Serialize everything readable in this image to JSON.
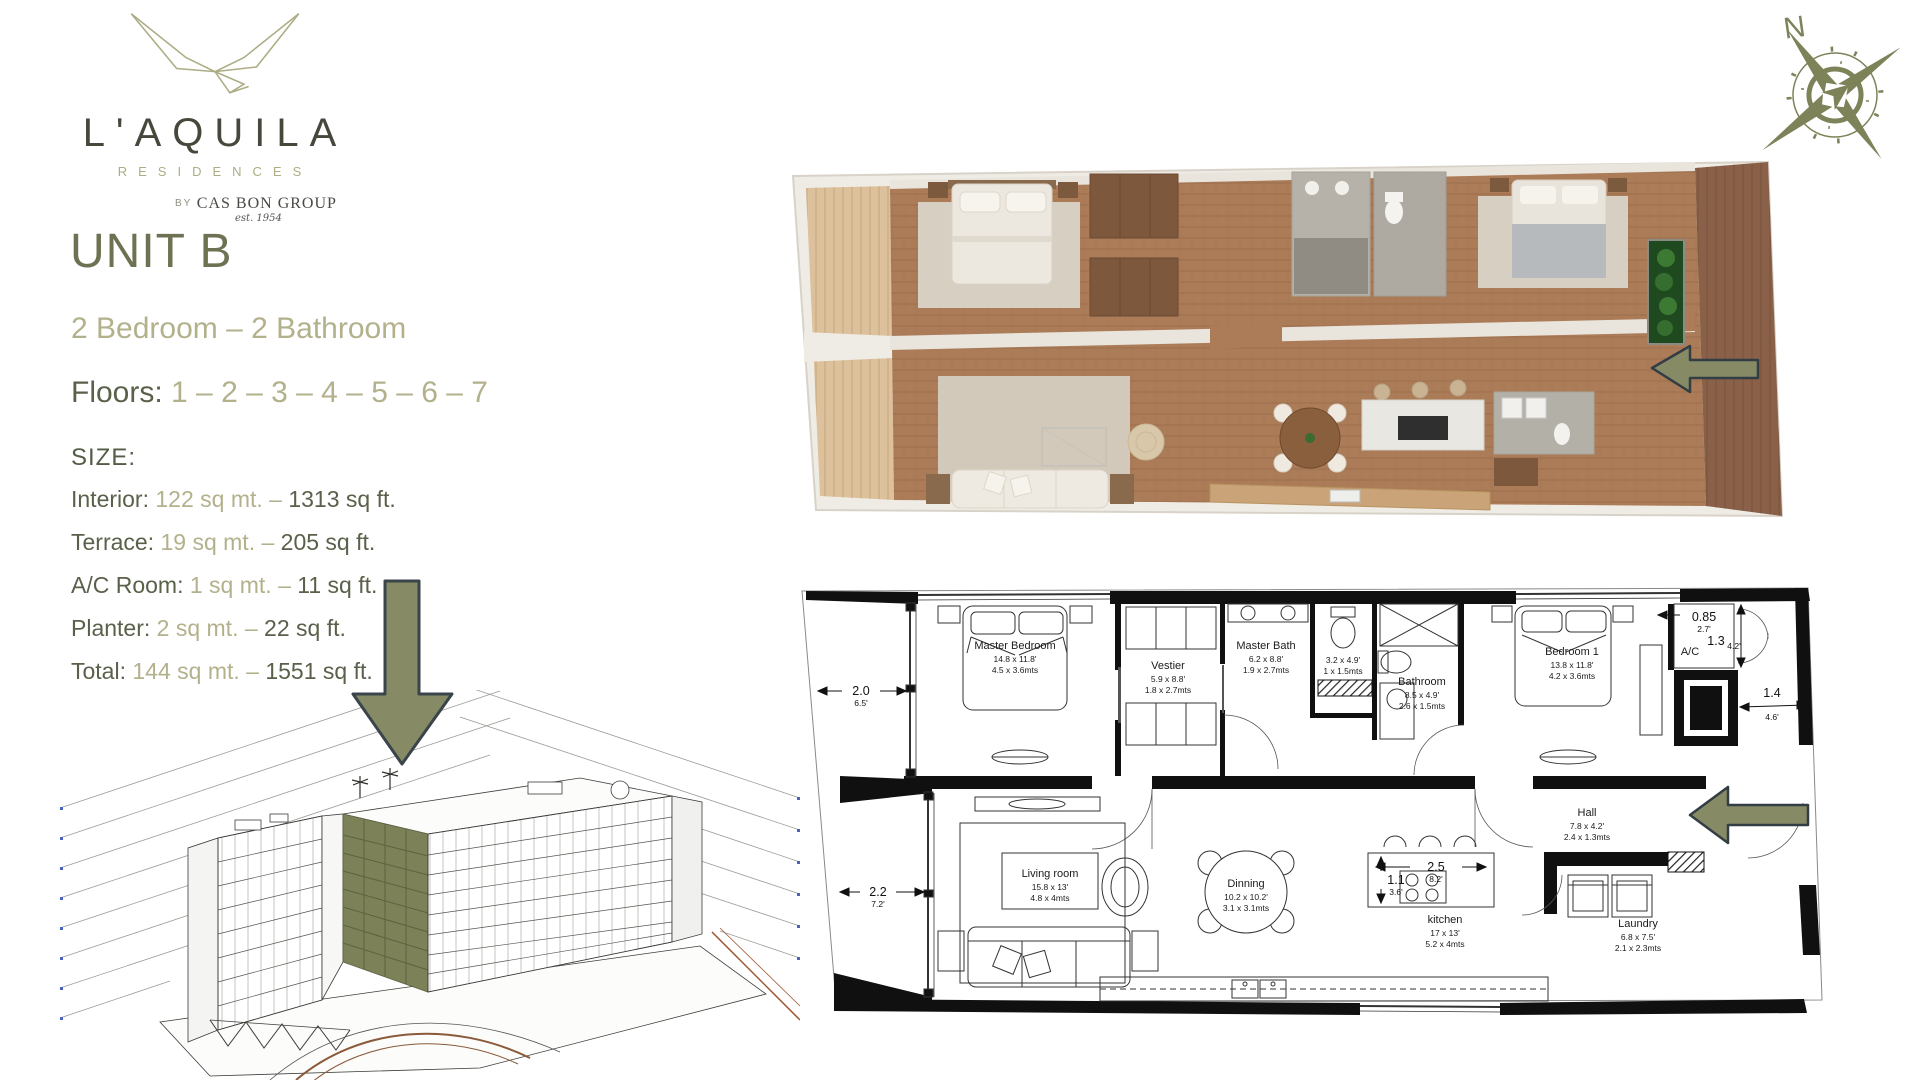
{
  "brand": {
    "wordmark": "L'AQUILA",
    "sub": "RESIDENCES",
    "by_prefix": "BY",
    "by_name": "CAS BON GROUP",
    "est": "est. 1954"
  },
  "unit": {
    "title": "UNIT B",
    "configuration": "2 Bedroom – 2 Bathroom",
    "floors_label": "Floors:",
    "floors_value": "1 – 2 – 3 – 4 – 5 – 6 – 7"
  },
  "size": {
    "heading": "SIZE:",
    "rows": [
      {
        "label": "Interior:",
        "metric": "122 sq mt.",
        "dash": "–",
        "imperial": "1313 sq ft."
      },
      {
        "label": "Terrace:",
        "metric": "19 sq mt.",
        "dash": "–",
        "imperial": "205 sq ft."
      },
      {
        "label": "A/C Room:",
        "metric": "1 sq mt.",
        "dash": "–",
        "imperial": "11 sq ft."
      },
      {
        "label": "Planter:",
        "metric": "2 sq mt.",
        "dash": "–",
        "imperial": "22 sq ft."
      },
      {
        "label": "Total:",
        "metric": "144 sq mt.",
        "dash": "–",
        "imperial": "1551 sq ft."
      }
    ]
  },
  "compass": {
    "north": "N"
  },
  "plan2d": {
    "rooms": {
      "master_bedroom": {
        "name": "Master Bedroom",
        "ft": "14.8 x 11.8'",
        "m": "4.5 x 3.6mts"
      },
      "vestier": {
        "name": "Vestier",
        "ft": "5.9 x 8.8'",
        "m": "1.8 x 2.7mts"
      },
      "master_bath": {
        "name": "Master Bath",
        "ft": "6.2 x 8.8'",
        "m": "1.9 x 2.7mts"
      },
      "wc": {
        "ft": "3.2 x 4.9'",
        "m": "1 x 1.5mts"
      },
      "bathroom": {
        "name": "Bathroom",
        "ft": "8.5 x 4.9'",
        "m": "2.6 x 1.5mts"
      },
      "bedroom1": {
        "name": "Bedroom 1",
        "ft": "13.8 x 11.8'",
        "m": "4.2 x 3.6mts"
      },
      "hall": {
        "name": "Hall",
        "ft": "7.8 x 4.2'",
        "m": "2.4 x 1.3mts"
      },
      "living": {
        "name": "Living room",
        "ft": "15.8 x 13'",
        "m": "4.8 x 4mts"
      },
      "dining": {
        "name": "Dinning",
        "ft": "10.2 x 10.2'",
        "m": "3.1 x 3.1mts"
      },
      "kitchen": {
        "name": "kitchen",
        "ft": "17 x 13'",
        "m": "5.2 x 4mts"
      },
      "laundry": {
        "name": "Laundry",
        "ft": "6.8 x 7.5'",
        "m": "2.1 x 2.3mts"
      }
    },
    "dims": {
      "left_top": {
        "m": "2.0",
        "ft": "6.5'"
      },
      "left_bottom": {
        "m": "2.2",
        "ft": "7.2'"
      },
      "top_right": {
        "m": "0.85",
        "ft": "2.7'"
      },
      "ac": {
        "label": "A/C",
        "m": "1.3",
        "ft": "4.2'"
      },
      "right": {
        "m": "1.4",
        "ft": "4.6'"
      },
      "island_width": {
        "m": "2.5",
        "ft": "8.2'"
      },
      "island_depth": {
        "m": "1.1",
        "ft": "3.6'"
      }
    }
  },
  "colors": {
    "sage": "#b3b18c",
    "olive_dark": "#5a614a",
    "unit_title": "#6f7252",
    "arrow_fill": "#868b66",
    "arrow_stroke": "#39444b",
    "highlight": "#7c8157"
  }
}
